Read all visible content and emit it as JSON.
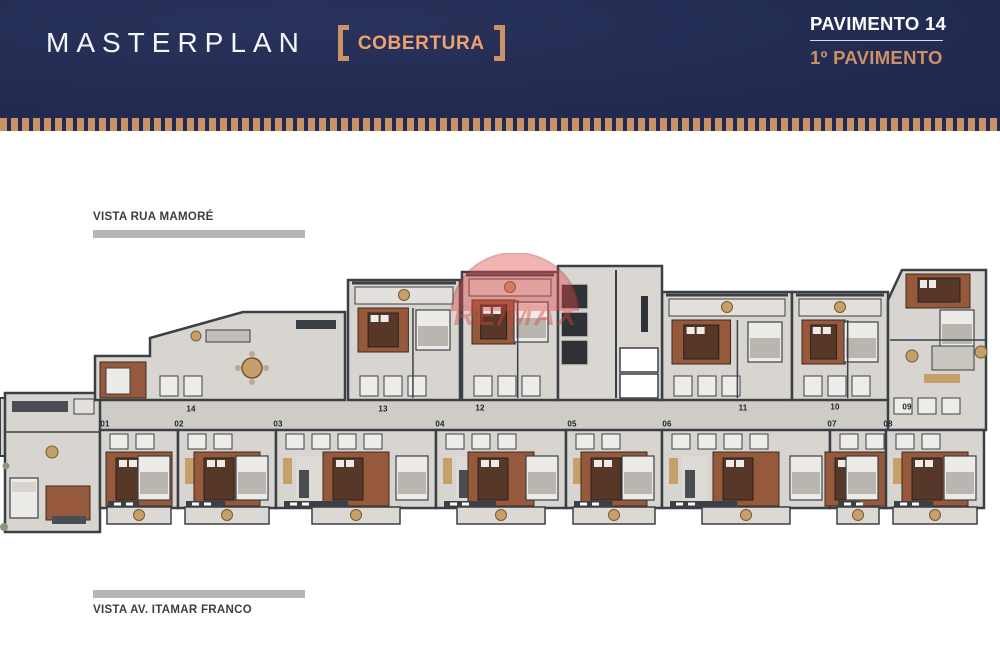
{
  "header": {
    "title": "MASTERPLAN",
    "badge": "COBERTURA",
    "right_primary": "PAVIMENTO 14",
    "right_secondary": "1º PAVIMENTO"
  },
  "plan": {
    "vista_top": "VISTA RUA MAMORÉ",
    "vista_bottom": "VISTA AV. ITAMAR FRANCO",
    "watermark": "RE/MAX",
    "units": [
      {
        "id": "14",
        "x": 191,
        "y": 409
      },
      {
        "id": "13",
        "x": 383,
        "y": 409
      },
      {
        "id": "12",
        "x": 480,
        "y": 408
      },
      {
        "id": "11",
        "x": 743,
        "y": 408
      },
      {
        "id": "10",
        "x": 835,
        "y": 407
      },
      {
        "id": "09",
        "x": 907,
        "y": 407
      },
      {
        "id": "01",
        "x": 105,
        "y": 424
      },
      {
        "id": "02",
        "x": 179,
        "y": 424
      },
      {
        "id": "03",
        "x": 278,
        "y": 424
      },
      {
        "id": "04",
        "x": 440,
        "y": 424
      },
      {
        "id": "05",
        "x": 572,
        "y": 424
      },
      {
        "id": "06",
        "x": 667,
        "y": 424
      },
      {
        "id": "07",
        "x": 832,
        "y": 424
      },
      {
        "id": "08",
        "x": 888,
        "y": 424
      }
    ]
  },
  "colors": {
    "navy": "#212a54",
    "copper": "#cd9166",
    "copper-text": "#eda271",
    "remax-red": "#df4040",
    "bar-gray": "#b5b5b5",
    "vista-text": "#3e3e3e"
  }
}
